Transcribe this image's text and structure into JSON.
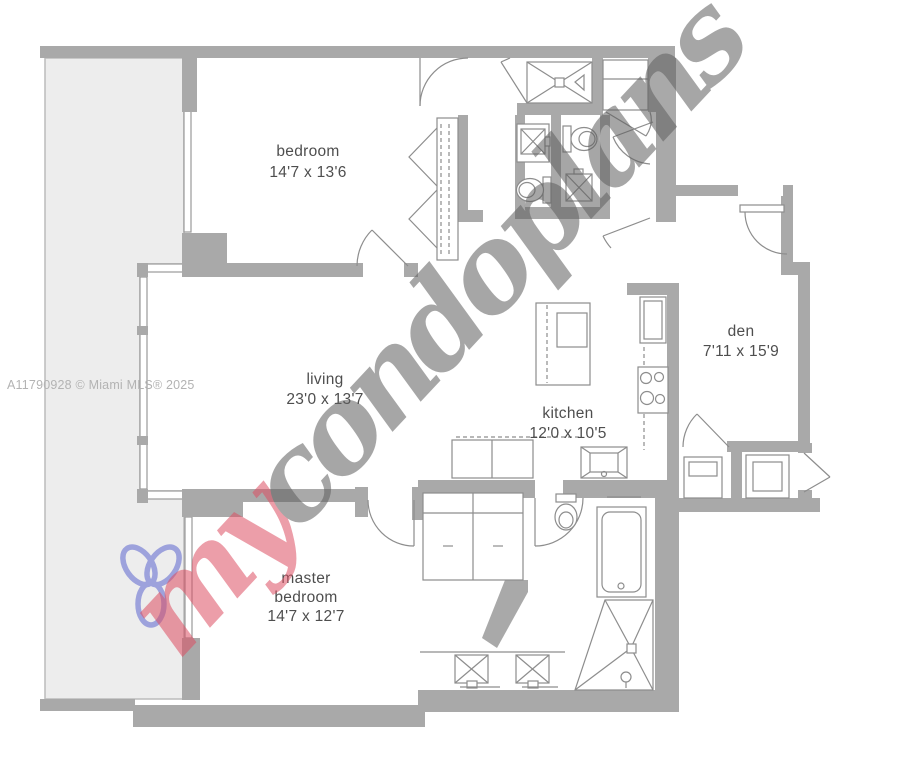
{
  "attribution": {
    "text": "A11790928 © Miami MLS® 2025"
  },
  "watermark": {
    "prefix": "my",
    "suffix": "condoplans",
    "logo_icon": "trefoil-flower-icon",
    "pink": "#dd7583",
    "gray": "#828282",
    "logo_blue": "#8a90d8"
  },
  "rooms": {
    "bedroom": {
      "label": "bedroom",
      "dims": "14'7 x 13'6"
    },
    "living": {
      "label": "living",
      "dims": "23'0 x 13'7"
    },
    "kitchen": {
      "label": "kitchen",
      "dims": "12'0 x 10'5"
    },
    "den": {
      "label": "den",
      "dims": "7'11 x 15'9"
    },
    "master_bedroom": {
      "label_line1": "master",
      "label_line2": "bedroom",
      "dims": "14'7 x 12'7"
    }
  },
  "colors": {
    "wall": "#a9a9a9",
    "balcony_fill": "#ededed",
    "fixture_line": "#8d8d8d",
    "label_text": "#4e4e4e",
    "attribution_text": "#b3b3b3"
  }
}
